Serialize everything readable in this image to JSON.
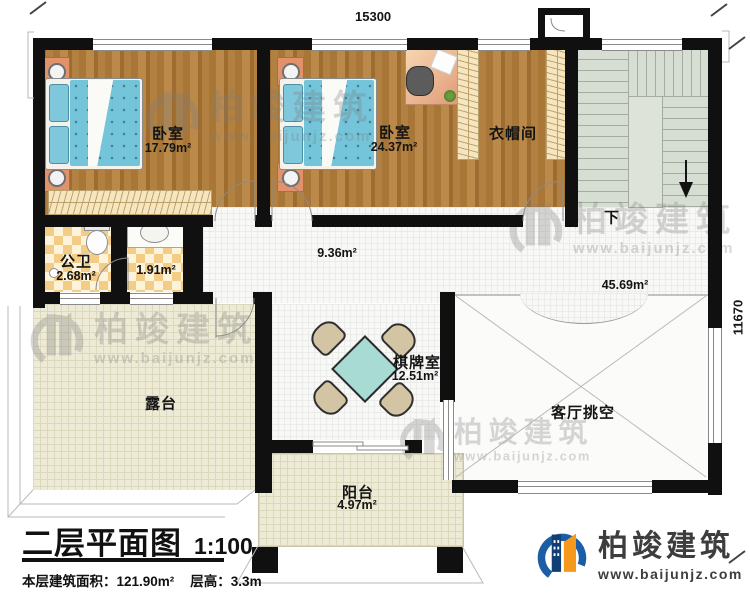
{
  "dimensions": {
    "top": "15300",
    "right": "11670"
  },
  "rooms": {
    "bedroom1": {
      "name": "卧室",
      "area": "17.79m²"
    },
    "bedroom2": {
      "name": "卧室",
      "area": "24.37m²"
    },
    "cloakroom": {
      "name": "衣帽间"
    },
    "bathroom": {
      "name": "公卫",
      "area": "2.68m²"
    },
    "washroom": {
      "area": "1.91m²"
    },
    "hallway": {
      "area": "9.36m²"
    },
    "stair_hall": {
      "area": "45.69m²"
    },
    "stairs": {
      "direction": "下"
    },
    "chess_room": {
      "name": "棋牌室",
      "area": "12.51m²"
    },
    "terrace": {
      "name": "露台"
    },
    "living_void": {
      "name": "客厅挑空"
    },
    "balcony": {
      "name": "阳台",
      "area": "4.97m²"
    }
  },
  "title_block": {
    "title": "二层平面图",
    "scale": "1:100",
    "area_label": "本层建筑面积：121.90m²",
    "height_label": "层高：3.3m"
  },
  "brand": {
    "name": "柏竣建筑",
    "url": "www.baijunjz.com"
  },
  "watermark": {
    "name": "柏竣建筑",
    "url": "www.baijunjz.com"
  },
  "colors": {
    "wall": "#101010",
    "wood": "#ab7a38",
    "bed": "#74c4da",
    "stairs": "#d6ddd2",
    "terrace": "#edead5",
    "checker": "#f3cd86",
    "table": "#a9dbd5",
    "logo_blue": "#1b5ea6",
    "logo_orange": "#f5991d"
  }
}
